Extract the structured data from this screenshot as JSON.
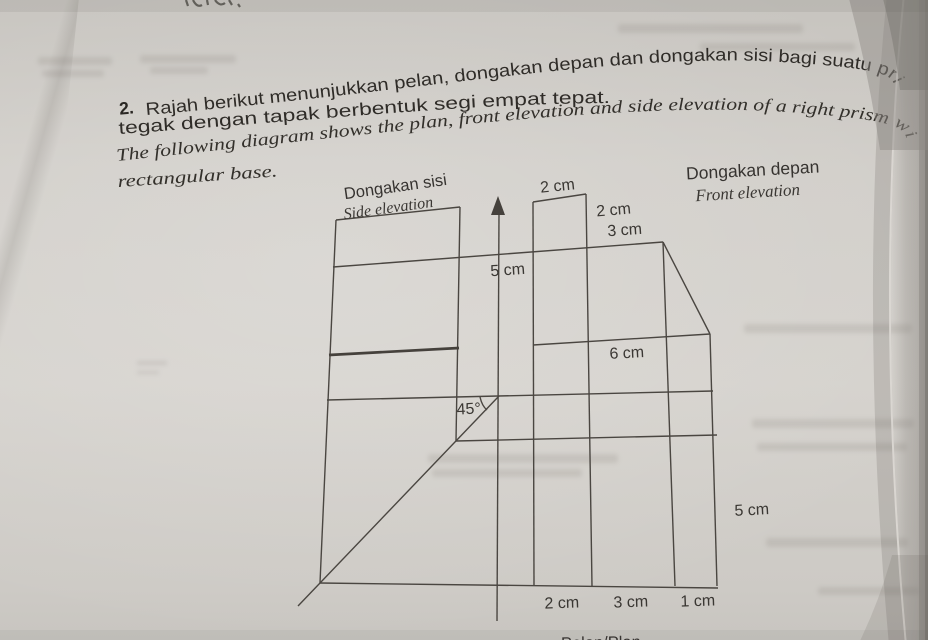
{
  "question": {
    "number": "2.",
    "malay_line1": "Rajah berikut menunjukkan pelan, dongakan depan dan dongakan sisi bagi suatu pri",
    "malay_line2": "tegak dengan tapak berbentuk segi empat tepat.",
    "english_line1": "The following diagram shows the plan, front elevation and side elevation of a right prism wi",
    "english_line2": "rectangular base."
  },
  "diagram": {
    "titles": {
      "side_my": "Dongakan sisi",
      "side_en": "Side elevation",
      "front_my": "Dongakan depan",
      "front_en": "Front elevation",
      "plan_partial": "Pelan/Plan"
    },
    "dimensions": {
      "tower_top_width": "2 cm",
      "tower_right_height": "2 cm",
      "shoulder_width": "3 cm",
      "fold_height": "5 cm",
      "body_width": "6 cm",
      "angle": "45°",
      "plan_depth": "5 cm",
      "plan_seg1": "2 cm",
      "plan_seg2": "3 cm",
      "plan_seg3": "1 cm"
    }
  }
}
